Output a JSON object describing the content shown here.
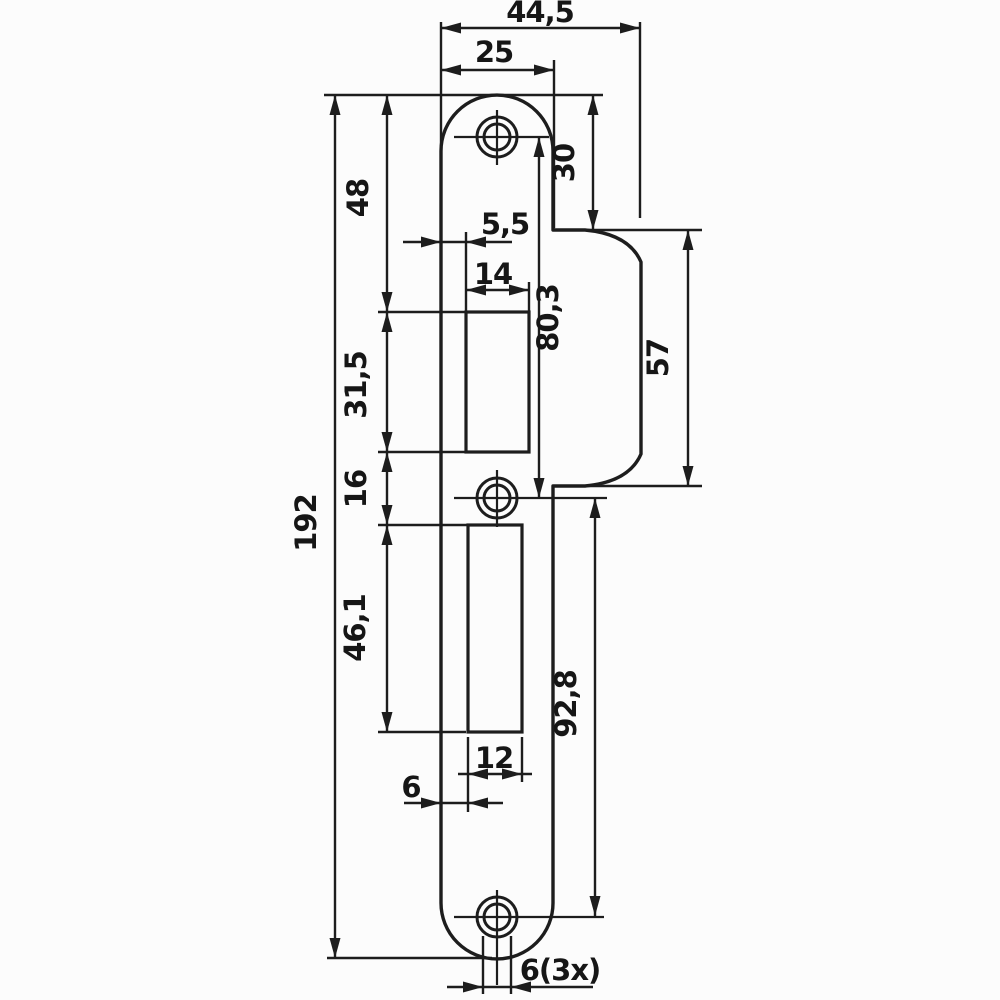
{
  "drawing": {
    "type": "technical-dimension-drawing",
    "subject": "lock strike plate, front view, metric dimensions",
    "colors": {
      "line": "#1d1d1d",
      "background": "#fcfcfc"
    },
    "dims": {
      "overall_width": "44,5",
      "plate_width": "25",
      "top_to_lip": "30",
      "top_to_latch_cutout": "48",
      "edge_to_latch_cutout": "5,5",
      "latch_cutout_width": "14",
      "top_hole_to_mid_hole": "80,3",
      "lip_length": "57",
      "latch_cutout_height": "31,5",
      "cutout_gap": "16",
      "overall_height": "192",
      "bolt_cutout_height": "46,1",
      "mid_hole_to_bottom_hole": "92,8",
      "bolt_cutout_width": "12",
      "edge_to_bolt_cutout": "6",
      "screw_hole_diameter": "6(3x)"
    }
  }
}
